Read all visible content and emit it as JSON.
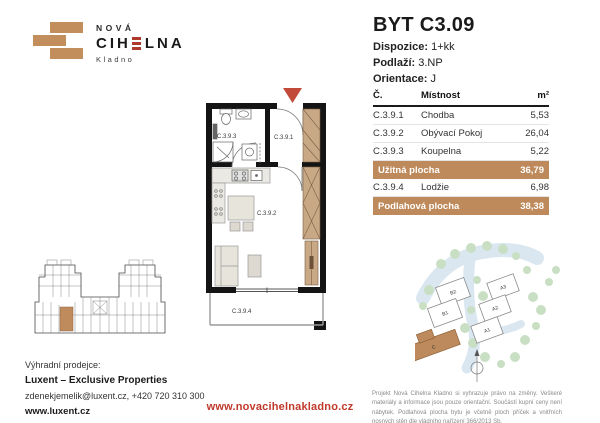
{
  "logo": {
    "nova": "NOVÁ",
    "cihelna_pre": "CIH",
    "cihelna_post": "LNA",
    "city": "Kladno"
  },
  "header": {
    "title": "BYT C3.09",
    "dispozice_label": "Dispozice:",
    "dispozice_value": "1+kk",
    "podlazi_label": "Podlaží:",
    "podlazi_value": "3.NP",
    "orientace_label": "Orientace:",
    "orientace_value": "J"
  },
  "table": {
    "col_num": "Č.",
    "col_room": "Místnost",
    "col_area": "m²",
    "rows": [
      {
        "num": "C.3.9.1",
        "room": "Chodba",
        "area": "5,53"
      },
      {
        "num": "C.3.9.2",
        "room": "Obývací Pokoj",
        "area": "26,04"
      },
      {
        "num": "C.3.9.3",
        "room": "Koupelna",
        "area": "5,22"
      }
    ],
    "usable_label": "Užitná plocha",
    "usable_value": "36,79",
    "loggia_row": {
      "num": "C.3.9.4",
      "room": "Lodžie",
      "area": "6,98"
    },
    "floor_label": "Podlahová plocha",
    "floor_value": "38,38"
  },
  "floorplan": {
    "room1": "C.3.9.1",
    "room2": "C.3.9.2",
    "room3": "C.3.9.3",
    "room4": "C.3.9.4"
  },
  "siteplan": {
    "b2": "B2",
    "b1": "B1",
    "a3": "A3",
    "a2": "A2",
    "a1": "A1",
    "c": "C"
  },
  "footer": {
    "seller_label": "Výhradní prodejce:",
    "seller_name": "Luxent – Exclusive Properties",
    "seller_contact": "zdenekjemelik@luxent.cz, +420 720 310 300",
    "seller_web": "www.luxent.cz",
    "project_web": "www.novacihelnakladno.cz",
    "disclaimer": "Projekt Nová Cihelna Kladno si vyhrazuje právo na změny. Veškeré materiály a informace jsou pouze orientační. Součástí kupní ceny není nábytek. Podlahová plocha bytu je včetně ploch příček a vnitřních nosných stěn dle vládního nařízení 366/2013 Sb."
  },
  "colors": {
    "brand_tan": "#c08b5c",
    "brand_red": "#b0392e",
    "accent_red": "#c0392b",
    "wall_black": "#141414"
  }
}
